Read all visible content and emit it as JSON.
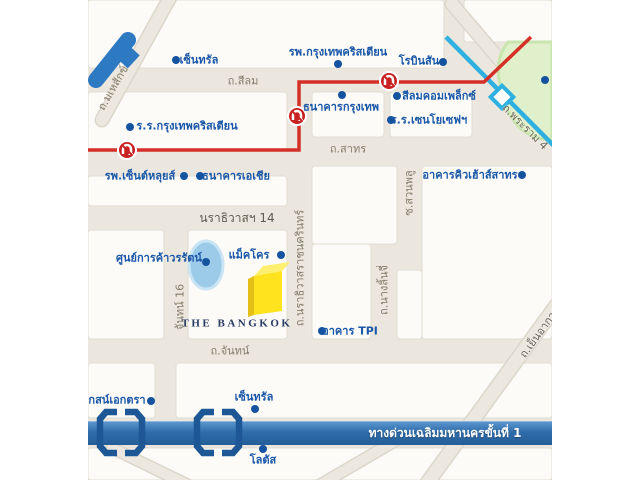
{
  "map": {
    "type": "static-location-map",
    "colors": {
      "poi_text_blue": "#1A57A8",
      "road_label_gray": "#857D6B",
      "road_beige": "#EBE7DE",
      "block_white": "#FCFBF8",
      "route_red": "#D43028",
      "transit_cyan": "#2EB1E0",
      "expressway_blue": "#2E6CA9",
      "park_green": "#DFF0CA",
      "pond_blue": "#9BCBE8",
      "building_yellow": "#FFE31E",
      "landmark_blue": "#2E7AC2"
    },
    "pois": [
      {
        "label": "เซ็นทรัล"
      },
      {
        "label": "รพ.กรุงเทพคริสเตียน"
      },
      {
        "label": "โรบินสัน"
      },
      {
        "label": "ร.ร.กรุงเทพคริสเตียน"
      },
      {
        "label": "ธนาคารกรุงเทพ"
      },
      {
        "label": "สีลมคอมเพล็กซ์"
      },
      {
        "label": "ร.ร.เซนโยเซฟฯ"
      },
      {
        "label": "รพ.เซ็นต์หลุยส์"
      },
      {
        "label": "ธนาคารเอเชีย"
      },
      {
        "label": "อาคารคิวเฮ้าส์สาทร"
      },
      {
        "label": "ศูนย์การค้าวรรัตน์"
      },
      {
        "label": "แม็คโคร"
      },
      {
        "label": "อาคาร TPI"
      },
      {
        "label": "เซ็นทรัล"
      },
      {
        "label": "โลตัส"
      },
      {
        "label": "กสน์เอกตรา"
      }
    ],
    "roads": [
      {
        "label": "ถ.มเหสักข์"
      },
      {
        "label": "ถ.สีลม"
      },
      {
        "label": "ถ.สาทร"
      },
      {
        "label": "นราธิวาสฯ 14"
      },
      {
        "label": "ถ.นราธิวาสราชนครินทร์"
      },
      {
        "label": "จันทน์ 16"
      },
      {
        "label": "ซ.สวนพลู"
      },
      {
        "label": "ถ.นางลิ้นจี่"
      },
      {
        "label": "ถ.จันทน์"
      },
      {
        "label": "ถ.เย็นอากาศ"
      },
      {
        "label": "ถ.พระราม 4"
      }
    ],
    "landmarks": {
      "the_bangkok": "THE BANGKOK"
    },
    "expressway": {
      "label": "ทางด่วนเฉลิมมหานครขั้นที่ 1"
    }
  }
}
